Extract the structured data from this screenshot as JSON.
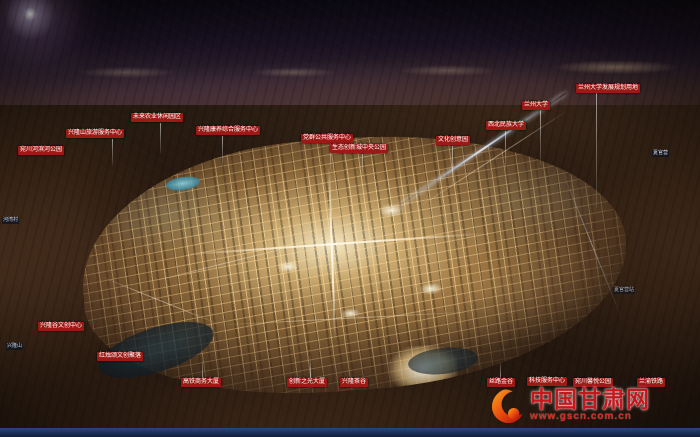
{
  "scene": {
    "description": "夜景鸟瞰效果图：群山环抱中的生态创新城规划全景，中部城区灯光通明",
    "colors": {
      "label_bg": "#9c1a15",
      "label_text": "#ffffff",
      "city_glow": "#f3cd87",
      "sky": "#171020",
      "bottom_band": "#1c3263",
      "watermark_red": "#c5181d"
    }
  },
  "labels": [
    {
      "id": "wanchuan-river-park",
      "text": "宛川河滨河公园"
    },
    {
      "id": "xinglongshan-tourism-center",
      "text": "兴隆山旅游服务中心"
    },
    {
      "id": "future-agriculture-park",
      "text": "未来农业休闲园区"
    },
    {
      "id": "kangyang-service-center",
      "text": "兴隆康养综合服务中心"
    },
    {
      "id": "public-service-center",
      "text": "党群公共服务中心"
    },
    {
      "id": "central-park",
      "text": "生态创新城中央公园"
    },
    {
      "id": "culture-creative-park",
      "text": "文化创意园"
    },
    {
      "id": "northwest-minzu-university",
      "text": "西北民族大学"
    },
    {
      "id": "lanzhou-university",
      "text": "兰州大学"
    },
    {
      "id": "lzu-development-area",
      "text": "兰州大学发展规划用地"
    },
    {
      "id": "wenchuang-center",
      "text": "兴隆谷文创中心"
    },
    {
      "id": "hongzhusong-cluster",
      "text": "红烛颂文创聚落"
    },
    {
      "id": "hsr-business-tower",
      "text": "高铁商务大厦"
    },
    {
      "id": "innovation-light-tower",
      "text": "创新之光大厦"
    },
    {
      "id": "xinglong-tea-valley",
      "text": "兴隆茶谷"
    },
    {
      "id": "silkroad-gold-valley",
      "text": "丝路金谷"
    },
    {
      "id": "tech-service-center",
      "text": "科技服务中心"
    },
    {
      "id": "wanchuan-xinyue-park",
      "text": "宛川馨悦公园"
    },
    {
      "id": "lanyu-railway",
      "text": "兰渝铁路"
    }
  ],
  "badges": [
    {
      "id": "hewan-village",
      "text": "河湾村"
    },
    {
      "id": "xinglongshan",
      "text": "兴隆山"
    },
    {
      "id": "xiaguanying",
      "text": "夏官营"
    },
    {
      "id": "xiaguanying-station",
      "text": "夏官营站"
    }
  ],
  "watermark": {
    "site_name": "中国甘肃网",
    "url": "www.gscn.com.cn",
    "logo": "gansu-flame-swirl-logo"
  }
}
